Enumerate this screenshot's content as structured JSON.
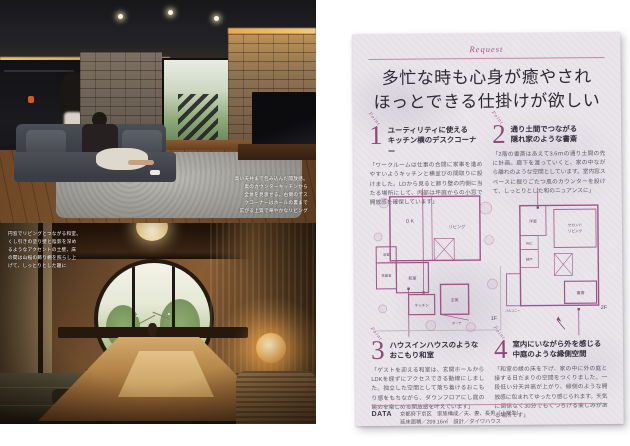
{
  "accent": {
    "magenta": "#8e4877",
    "rule": "#bc8ba8",
    "paper": "#e9e5ea",
    "title_ink": "#2e2833"
  },
  "photos": {
    "top": {
      "caption_lines": [
        "高い天井まで包み込んだ開放感。",
        "奥のカウンターキッチンから",
        "全体を見渡せる。右側のデス",
        "クコーナーはホールの裏まで",
        "広がる上質で華やかなリビング"
      ]
    },
    "bottom": {
      "caption_lines": [
        "円窓でリビングとつながる和室。",
        "くし引きの塗り壁と陰影を深め",
        "るようなアクセントの土壁、床",
        "の間は山桜の飾り棚を照らし上",
        "げて、しっとりとした趣に"
      ]
    }
  },
  "page": {
    "eyebrow": "Request",
    "title_line1": "多忙な時も心身が癒やされ",
    "title_line2": "ほっとできる仕掛けが欲しい",
    "points": [
      {
        "num": "1",
        "tag": "Point",
        "heading_line1": "ユーティリティに使える",
        "heading_line2": "キッチン横のデスクコーナー",
        "body": "「ワークルームは仕事の合間に家事を進めやすいようキッチンと横並びの間取りに設けました。LDから見ると飾り壁の内側に当たる場所にして、内部は坪庭からの小窓で開放感を確保しています」"
      },
      {
        "num": "2",
        "tag": "Point",
        "heading_line1": "通り土間でつながる",
        "heading_line2": "隠れ家のような書斎",
        "body": "「2階の書斎はあえて3.6ｍの通り土間の先に計画。廊下を渡っていくと、家の中ながら離れのような空間としています。室内窓スペースに掘りごたつ風のカウンターを設けて、しっとりとした和のニュアンスに」"
      },
      {
        "num": "3",
        "tag": "Point",
        "heading_line1": "ハウスインハウスのような",
        "heading_line2": "おこもり和室",
        "body": "「ゲストを迎える和室は、玄関ホールからLDKを経ずにアクセスできる動線にしました。独立した空間として落ち着けるおこもり感をもちながら、ダウンフロアにし庭の眺めを楽しめる開放感を叶えています」"
      },
      {
        "num": "4",
        "tag": "Point",
        "heading_line1": "室内にいながら外を感じる",
        "heading_line2": "中庭のような縁側空間",
        "body": "「和室の縁の床を下げ、家の中に外の庭と接する日だまりの空間をつくりました。一段低い分天井高が上がり、縁側のような開放感に包まれてゆったり感じられます。天気に関係なく30分でもくつろげる楽しみがある場所です」"
      }
    ],
    "plans": {
      "f1": {
        "label": "1F",
        "rooms": [
          "ＤＫ",
          "リビング",
          "和室",
          "浴室",
          "洗面室",
          "キッチン",
          "玄関",
          "ポーチ"
        ]
      },
      "f2": {
        "label": "2F",
        "rooms": [
          "洋室",
          "WIC",
          "納戸",
          "セカンド",
          "リビング",
          "書斎",
          "バルコニー"
        ]
      }
    },
    "data_section": {
      "label": "DATA",
      "line1": "京都府下京区　家族構成／夫、妻、長男（小学生）",
      "line2": "延床面積／209.16㎡　設計／ダイワハウス"
    }
  }
}
